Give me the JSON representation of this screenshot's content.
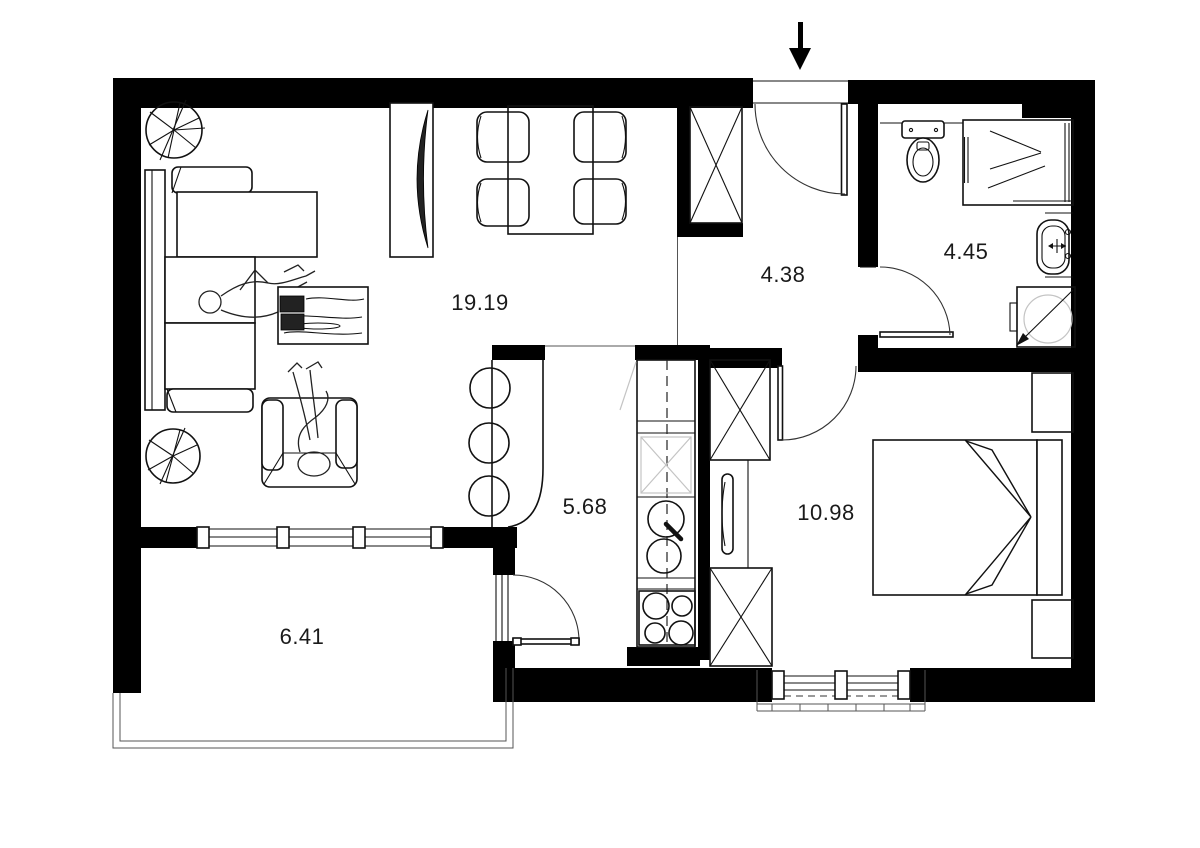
{
  "plan": {
    "type": "apartment-floor-plan",
    "colors": {
      "wall": "#000000",
      "line": "#111111",
      "background": "#ffffff"
    },
    "icons": [
      "entrance-arrow",
      "door-swing-arc",
      "wardrobe-cross",
      "plant",
      "shower-chevron"
    ],
    "rooms": {
      "living": {
        "name": "living-room",
        "area": "19.19"
      },
      "hall": {
        "name": "hallway",
        "area": "4.38"
      },
      "bath": {
        "name": "bathroom",
        "area": "4.45"
      },
      "kitchen": {
        "name": "kitchen",
        "area": "5.68"
      },
      "bedroom": {
        "name": "bedroom",
        "area": "10.98"
      },
      "balcony": {
        "name": "balcony",
        "area": "6.41"
      }
    }
  }
}
